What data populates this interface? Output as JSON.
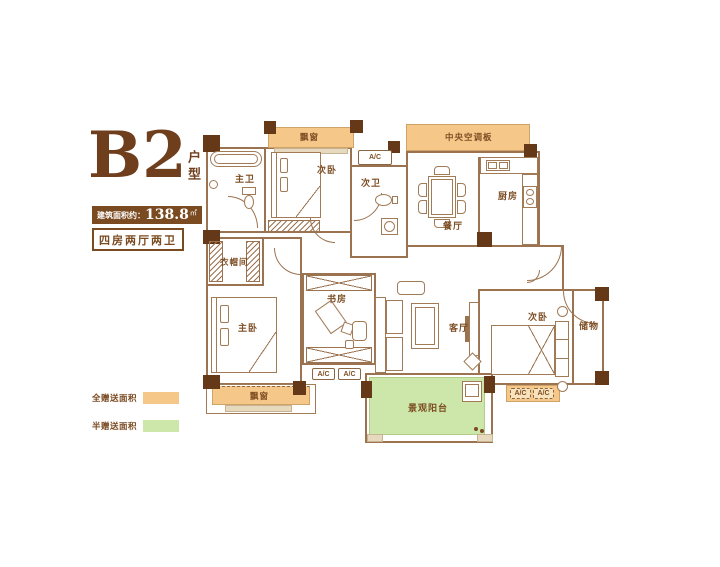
{
  "panel": {
    "plan_code": "B2",
    "plan_code_suffix": "户型",
    "area_label": "建筑面积约：",
    "area_value": "138.8",
    "area_unit": "㎡",
    "config": "四房两厅两卫",
    "legend": [
      {
        "label": "全赠送面积",
        "color": "#f5c789"
      },
      {
        "label": "半赠送面积",
        "color": "#cde6a9"
      }
    ]
  },
  "rooms": {
    "bay_window_top": "飘窗",
    "bedroom2_top": "次卧",
    "master_bath": "主卫",
    "bath2": "次卫",
    "central_ac_panel": "中央空调板",
    "dining": "餐厅",
    "kitchen": "厨房",
    "cloakroom": "衣帽间",
    "master_bedroom": "主卧",
    "study": "书房",
    "living": "客厅",
    "bedroom2_right": "次卧",
    "storage": "储物",
    "balcony": "景观阳台",
    "bay_window_bottom": "飘窗",
    "ac_unit": "A/C"
  },
  "colors": {
    "wall_line": "#9b7350",
    "wall_fill": "#653917",
    "text_brown": "#7a4a21",
    "gift_full": "#f5c789",
    "gift_half": "#cde6a9"
  }
}
